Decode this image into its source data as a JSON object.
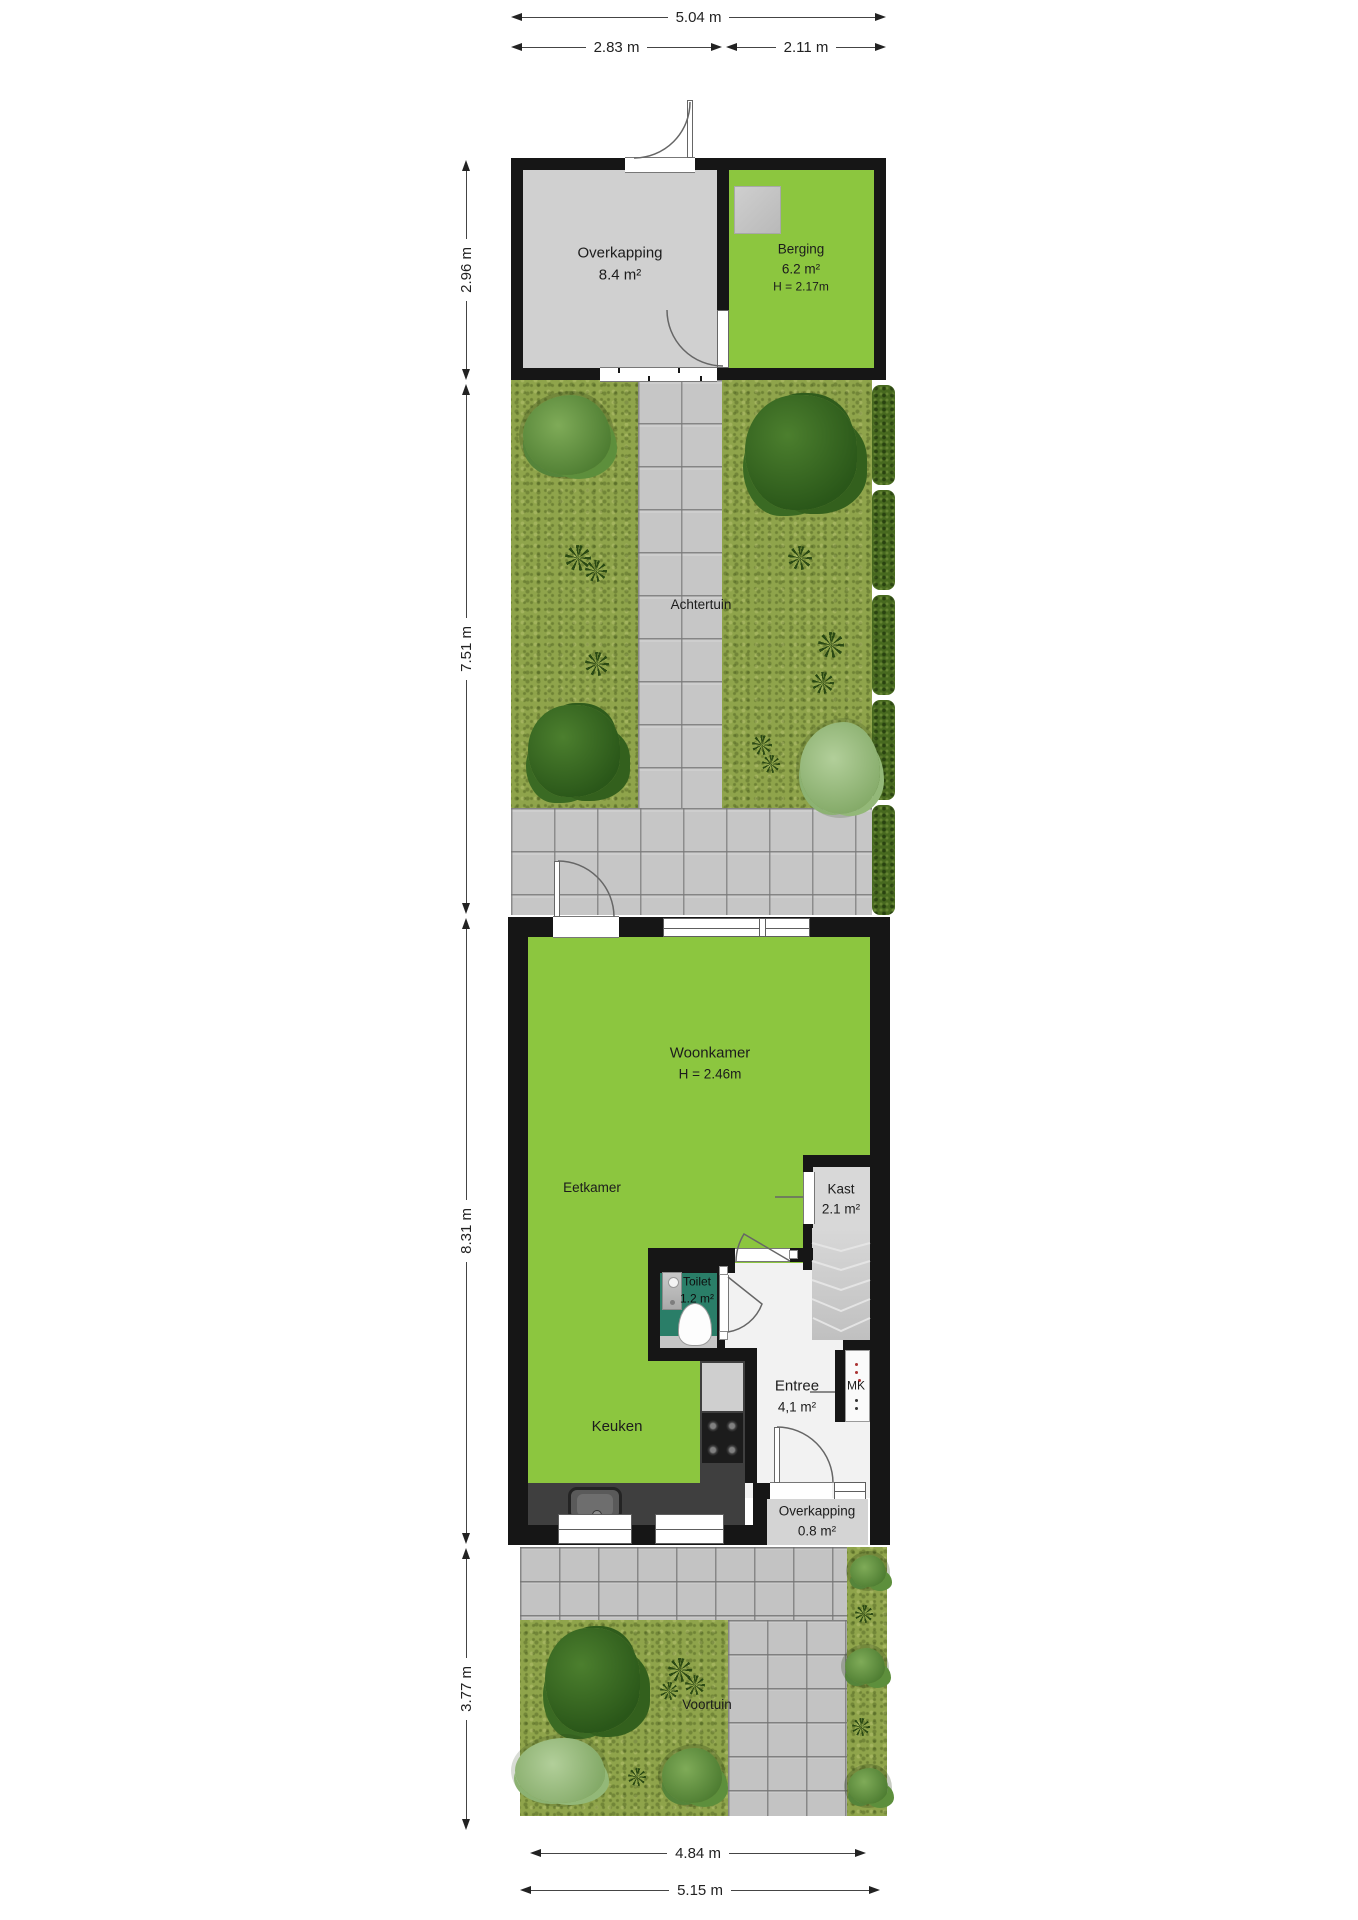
{
  "dims": {
    "top_total": "5.04 m",
    "top_left": "2.83 m",
    "top_right": "2.11 m",
    "left_top": "2.96 m",
    "left_garden": "7.51 m",
    "left_house": "8.31 m",
    "left_front": "3.77 m",
    "bottom_inner": "4.84 m",
    "bottom_outer": "5.15 m"
  },
  "rooms": {
    "overkapping_top": {
      "name": "Overkapping",
      "area": "8.4 m²"
    },
    "berging": {
      "name": "Berging",
      "area": "6.2 m²",
      "height": "H = 2.17m"
    },
    "achtertuin": {
      "name": "Achtertuin"
    },
    "woonkamer": {
      "name": "Woonkamer",
      "height": "H = 2.46m"
    },
    "eetkamer": {
      "name": "Eetkamer"
    },
    "kast": {
      "name": "Kast",
      "area": "2.1 m²"
    },
    "toilet": {
      "name": "Toilet",
      "area": "1.2 m²"
    },
    "entree": {
      "name": "Entree",
      "area": "4,1 m²"
    },
    "mk": {
      "name": "MK"
    },
    "keuken": {
      "name": "Keuken"
    },
    "overkapping_front": {
      "name": "Overkapping",
      "area": "0.8 m²"
    },
    "voortuin": {
      "name": "Voortuin"
    }
  },
  "colors": {
    "wall": "#161616",
    "room_green": "#8cc63f",
    "toilet_green": "#2a7e68",
    "room_gray": "#d0d0d0",
    "entree_white": "#f2f2f2",
    "grass": "#8fa44b",
    "path_gray": "#c6c6c6",
    "hedge_green": "#47691f",
    "counter_dark": "#3f3f3f"
  }
}
